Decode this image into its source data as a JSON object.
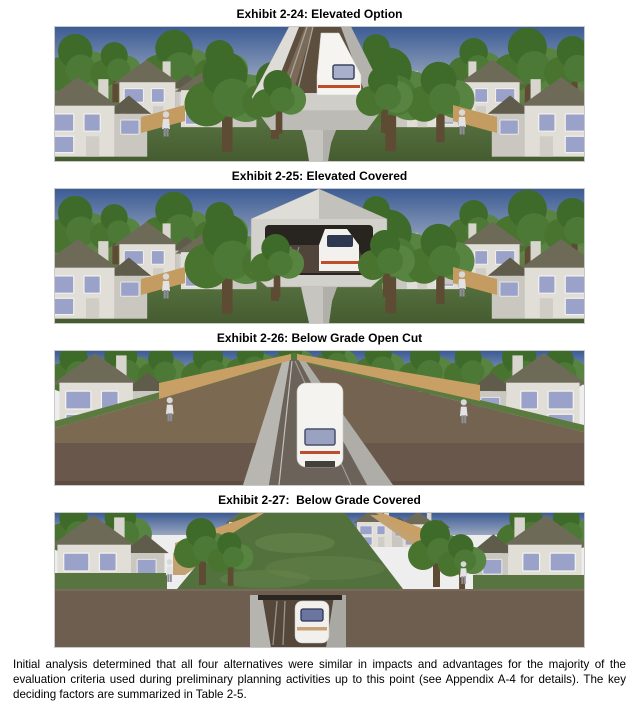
{
  "exhibits": [
    {
      "caption": "Exhibit 2-24: Elevated Option"
    },
    {
      "caption": "Exhibit 2-25: Elevated Covered"
    },
    {
      "caption": "Exhibit 2-26: Below Grade Open Cut"
    },
    {
      "caption": "Exhibit 2-27:  Below Grade Covered"
    }
  ],
  "paragraph": "Initial analysis determined that all four alternatives were similar in impacts and advantages for the majority of the evaluation criteria used during preliminary planning activities up to this point (see Appendix A-4 for details).  The key deciding factors are summarized in Table 2-5.",
  "colors": {
    "sky_top": "#3c5c95",
    "sky_bottom": "#9aa7bf",
    "grass": "#5e7b43",
    "foliage": "#4c7a36",
    "earth": "#6e5e50",
    "concrete": "#cfcec9",
    "house_wall": "#e0ded6",
    "roof": "#6e6a58",
    "window_glass": "#9aa2ca",
    "train_body": "#f4f3f0",
    "train_stripe": "#c14c2a",
    "fence_wood": "#c8a066",
    "text": "#000000"
  }
}
